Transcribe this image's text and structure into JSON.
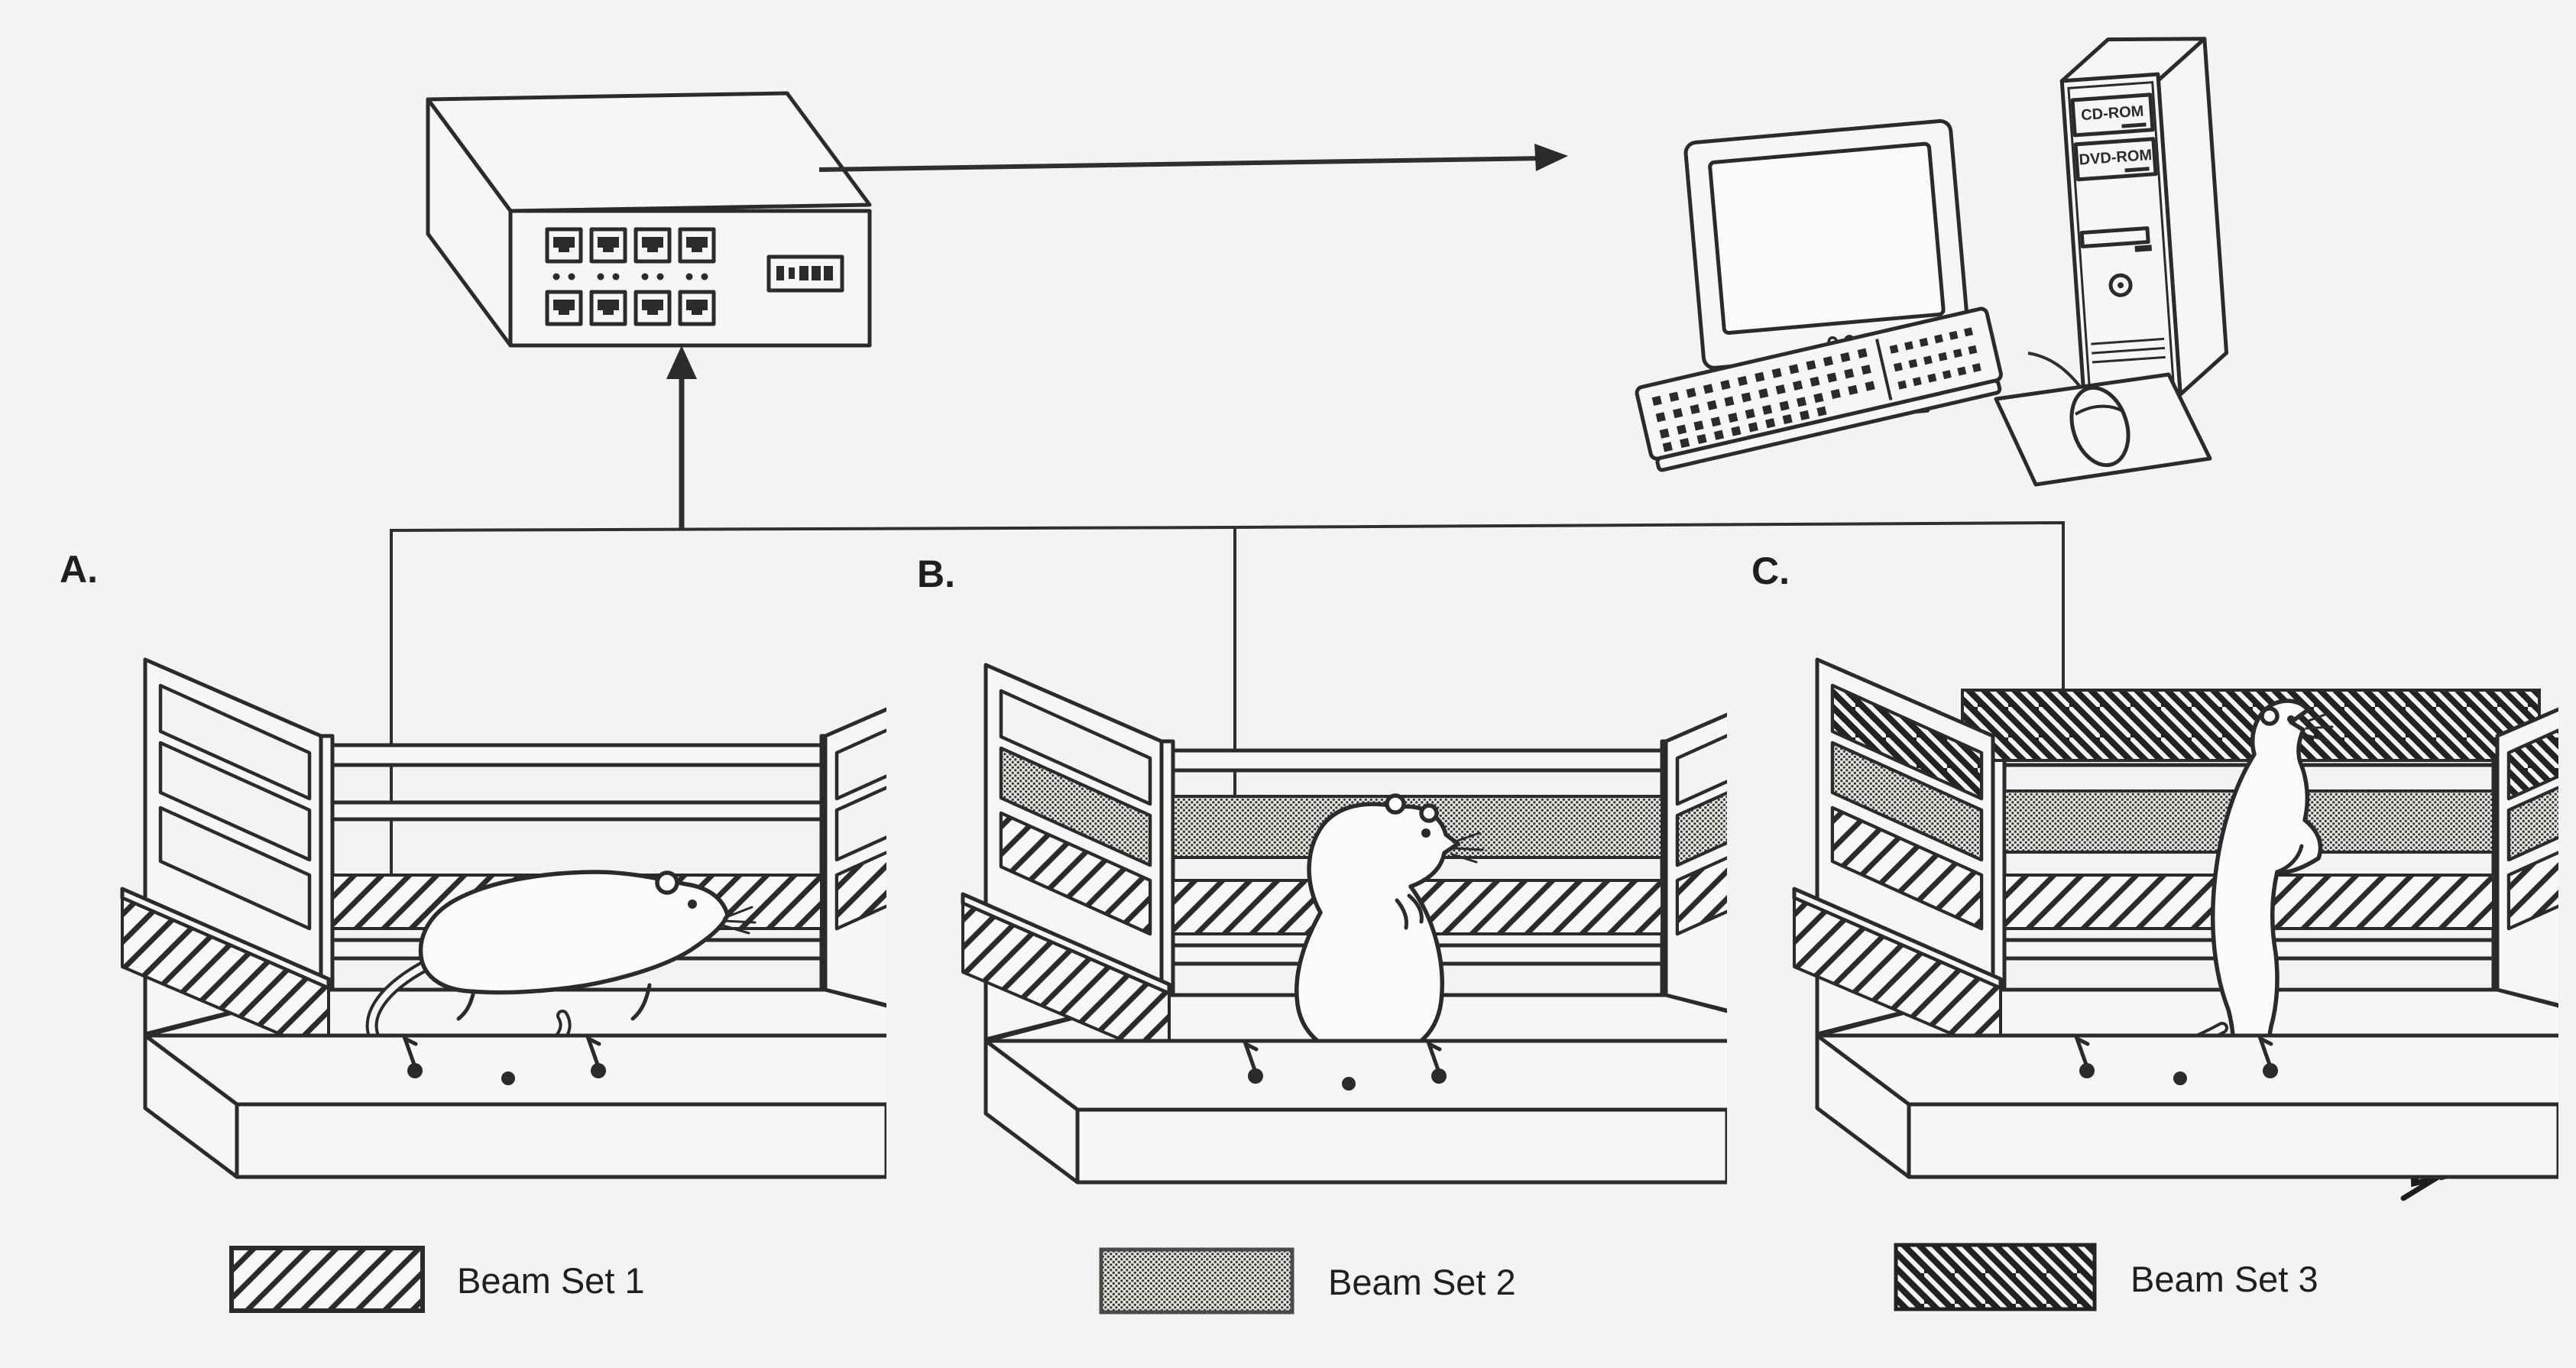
{
  "colors": {
    "background": "#f3f3f1",
    "ink": "#2b2b2b",
    "surface": "#f6f6f4",
    "beam3_background": "#232321"
  },
  "panels": [
    {
      "id": "A",
      "label": "A.",
      "beam_sets": [
        1
      ],
      "rat_pose": "exploring"
    },
    {
      "id": "B",
      "label": "B.",
      "beam_sets": [
        1,
        2
      ],
      "rat_pose": "sitting"
    },
    {
      "id": "C",
      "label": "C.",
      "beam_sets": [
        1,
        2,
        3
      ],
      "rat_pose": "rearing"
    }
  ],
  "legend": [
    {
      "label": "Beam Set 1",
      "pattern": "light-diagonal-hatch"
    },
    {
      "label": "Beam Set 2",
      "pattern": "gray-dot-grid"
    },
    {
      "label": "Beam Set 3",
      "pattern": "dark-diagonal-hatch"
    }
  ],
  "interface_box": {
    "jack_count": 8,
    "jack_rows": 2,
    "led_pairs": 4,
    "display_cells": 5
  },
  "computer": {
    "drive_labels": [
      "CD-ROM",
      "DVD-ROM"
    ]
  },
  "signature": {
    "text": "BKP"
  }
}
